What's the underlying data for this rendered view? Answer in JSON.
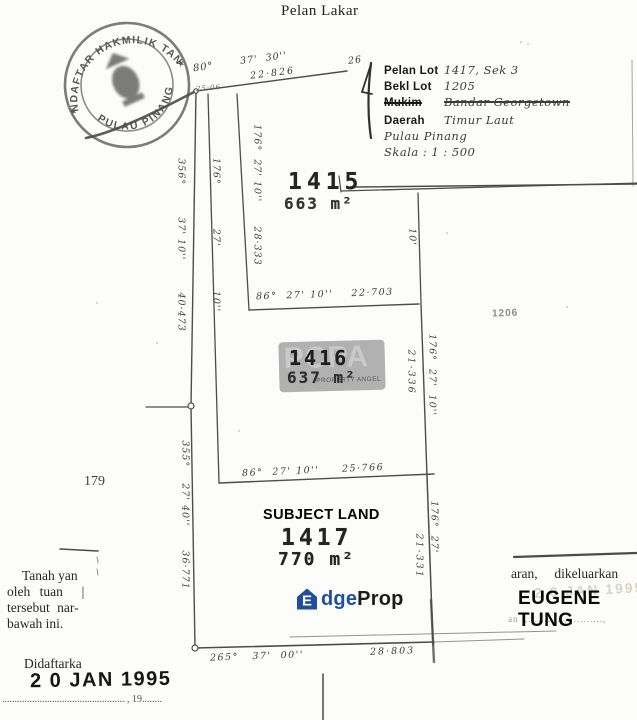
{
  "title": "Pelan Lakar",
  "stamp": {
    "arc_top": "PENDAFTAR HAKMILIK TANAH",
    "arc_bottom": "PULAU PINANG",
    "star": "★"
  },
  "info_box": {
    "rows": [
      {
        "label": "Pelan Lot",
        "value": "1417, Sek 3"
      },
      {
        "label": "Bekl Lot",
        "value": "1205"
      },
      {
        "label": "Mukim",
        "value": "Bandar Georgetown"
      },
      {
        "label": "Daerah",
        "value": "Timur Laut"
      },
      {
        "label": "",
        "value": "Pulau Pinang"
      },
      {
        "label": "",
        "value": "Skala :  1 : 500"
      }
    ]
  },
  "lots": {
    "lot1415": {
      "number": "1415",
      "area": "663 m²"
    },
    "lot1416": {
      "number": "1416",
      "area": "637 m²"
    },
    "lot1417": {
      "number": "1417",
      "area": "770 m²",
      "tag": "SUBJECT LAND"
    }
  },
  "neighbors": {
    "left": "179",
    "right": "1206"
  },
  "bearings": {
    "top_deg": "80°",
    "top_minsec": "37'  30''",
    "top_end": "26",
    "top_dist": "22·826",
    "top_note": "25·06",
    "west_upper": "356°        37' 10''        40·473",
    "mid_line": "176°           27'           10''",
    "lot1415_west": "176°  27' 10''      28·333",
    "lot1415_east": "10'",
    "div_1415_1416": "86°  27' 10''    22·703",
    "lot1416_east_brg": "176°  27'  10''",
    "lot1416_east_dist": "21·336",
    "div_1416_1417": "86°  27' 10''     25·766",
    "lot1417_east_brg": "176°  27'",
    "lot1417_east_dist": "21·331",
    "west_lower": "355°    27' 40''      36·771",
    "bottom_brg": "265°   37'  00''",
    "bottom_dist": "28·803"
  },
  "watermark": {
    "letters": "PCPA",
    "caption": "PROPERTY ANGEL"
  },
  "margins": {
    "left_line1": "Tanah yan",
    "left_line2": "oleh tuan  |",
    "left_line3": "tersebut nar-",
    "left_line4": "bawah ini.",
    "right_line": "aran,  dikeluarkan",
    "agent_name": "EUGENE TUNG",
    "right_dots": "an  ........................,",
    "ghost_date": "2 0 JAN 1995"
  },
  "registration": {
    "label": "Didaftarka",
    "date_stamp": "2 0 JAN 1995",
    "dotted_line": "................................................. , 19........"
  },
  "brand": {
    "logo_letter": "E",
    "text_blue": "dge",
    "text_dark": "Prop",
    "blue": "#1f4e9e"
  }
}
